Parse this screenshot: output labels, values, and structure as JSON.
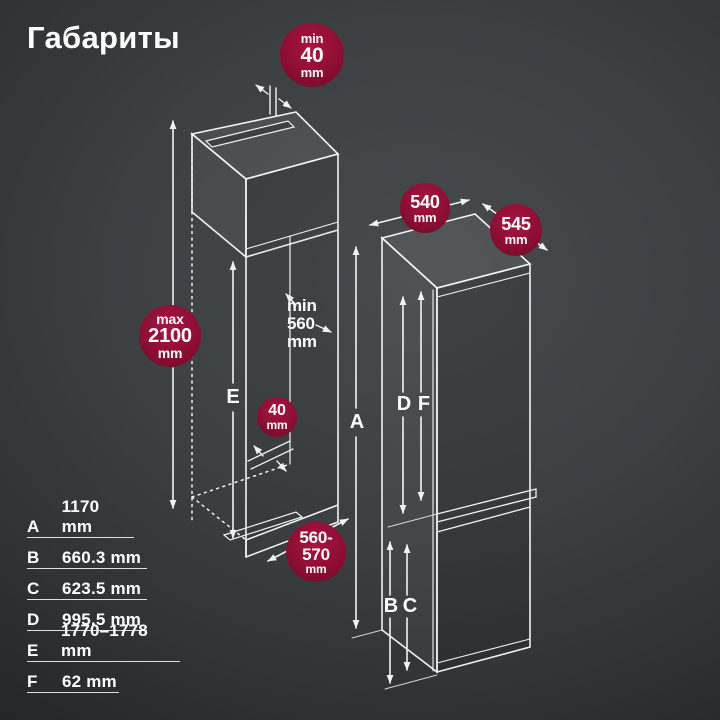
{
  "title": "Габариты",
  "badges": {
    "rear_top_gap": {
      "line1": "min",
      "line2": "40",
      "line3": "mm"
    },
    "fridge_width": {
      "line1": "540",
      "line2": "mm"
    },
    "fridge_depth": {
      "line1": "545",
      "line2": "mm"
    },
    "niche_max_height": {
      "line1": "max",
      "line2": "2100",
      "line3": "mm"
    },
    "rear_bottom_gap": {
      "line1": "40",
      "line2": "mm"
    },
    "niche_depth": {
      "line1": "560-",
      "line2": "570",
      "line3": "mm"
    }
  },
  "annotations": {
    "inner_min_depth": {
      "line1": "min",
      "line2": "560",
      "line3": "mm"
    }
  },
  "labels": {
    "a": "A",
    "b": "B",
    "c": "C",
    "d": "D",
    "e": "E",
    "f": "F"
  },
  "legend": {
    "rows": [
      {
        "letter": "A",
        "value": "1170 mm"
      },
      {
        "letter": "B",
        "value": "660.3 mm"
      },
      {
        "letter": "C",
        "value": "623.5 mm"
      },
      {
        "letter": "D",
        "value": "995.5 mm"
      },
      {
        "letter": "E",
        "value": "1770–1778 mm"
      },
      {
        "letter": "F",
        "value": "62 mm"
      }
    ]
  },
  "colors": {
    "background": "#3a3e41",
    "badge": "#8e0e33",
    "line": "#f1f2f3",
    "text": "#ffffff"
  }
}
